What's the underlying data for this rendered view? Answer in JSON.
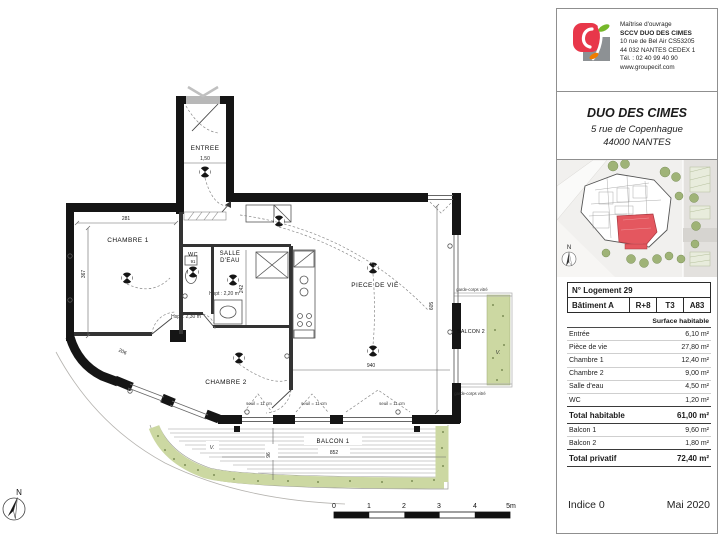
{
  "plan": {
    "labels": {
      "entree": "ENTREE",
      "chambre1": "CHAMBRE 1",
      "chambre2": "CHAMBRE 2",
      "salle_deau_line1": "SALLE",
      "salle_deau_line2": "D'EAU",
      "wc": "WC",
      "piece_de_vie": "PIECE DE VIE",
      "balcon1": "BALCON 1",
      "balcon2": "BALCON 2"
    },
    "annotations": {
      "hsp_sde": "Hspt : 2,20 m",
      "hsp_ch2": "Hspt : 2,30 m",
      "seuil": "seuil = 11 cm",
      "garde_corps": "garde-corps vitré",
      "planter": "V.",
      "north": "N"
    },
    "dimensions": {
      "corridor": "1,50",
      "ch1_width": "281",
      "ch1_height": "367",
      "wc_width": "91",
      "sde_height": "242",
      "living_height": "605",
      "living_width": "940",
      "balcon1_width": "852",
      "balcon1_depth": "96",
      "curve": "206"
    },
    "scalebar": [
      "0",
      "1",
      "2",
      "3",
      "4",
      "5m"
    ],
    "colors": {
      "wall": "#151515",
      "planter": "#ccd8a2",
      "door": "#b8b8b8"
    }
  },
  "panel": {
    "owner": {
      "heading": "Maîtrise d'ouvrage",
      "name": "SCCV DUO DES CIMES",
      "address1": "10 rue de Bel Air CS53205",
      "address2": "44 032 NANTES CEDEX 1",
      "phone": "Tél. : 02 40 99 40 90",
      "website": "www.groupecif.com"
    },
    "project": {
      "name": "DUO DES CIMES",
      "address": "5 rue de Copenhague",
      "city": "44000 NANTES"
    },
    "siteplan": {
      "north": "N",
      "highlight_color": "#e4575f"
    },
    "table": {
      "lot_title": "N° Logement 29",
      "building": "Bâtiment A",
      "floor": "R+8",
      "type": "T3",
      "lot_code": "A83",
      "surface_header": "Surface habitable",
      "rows": [
        {
          "label": "Entrée",
          "value": "6,10 m²"
        },
        {
          "label": "Pièce de vie",
          "value": "27,80 m²"
        },
        {
          "label": "Chambre 1",
          "value": "12,40 m²"
        },
        {
          "label": "Chambre 2",
          "value": "9,00 m²"
        },
        {
          "label": "Salle d'eau",
          "value": "4,50 m²"
        },
        {
          "label": "WC",
          "value": "1,20 m²"
        }
      ],
      "total_habitable": {
        "label": "Total habitable",
        "value": "61,00 m²"
      },
      "balconies": [
        {
          "label": "Balcon 1",
          "value": "9,60 m²"
        },
        {
          "label": "Balcon 2",
          "value": "1,80 m²"
        }
      ],
      "total_privatif": {
        "label": "Total privatif",
        "value": "72,40 m²"
      }
    },
    "footer": {
      "indice": "Indice 0",
      "date": "Mai 2020"
    },
    "logo_colors": {
      "red": "#e8374a",
      "gray": "#8d9194",
      "green": "#76b82a",
      "orange": "#ef7d00"
    }
  }
}
